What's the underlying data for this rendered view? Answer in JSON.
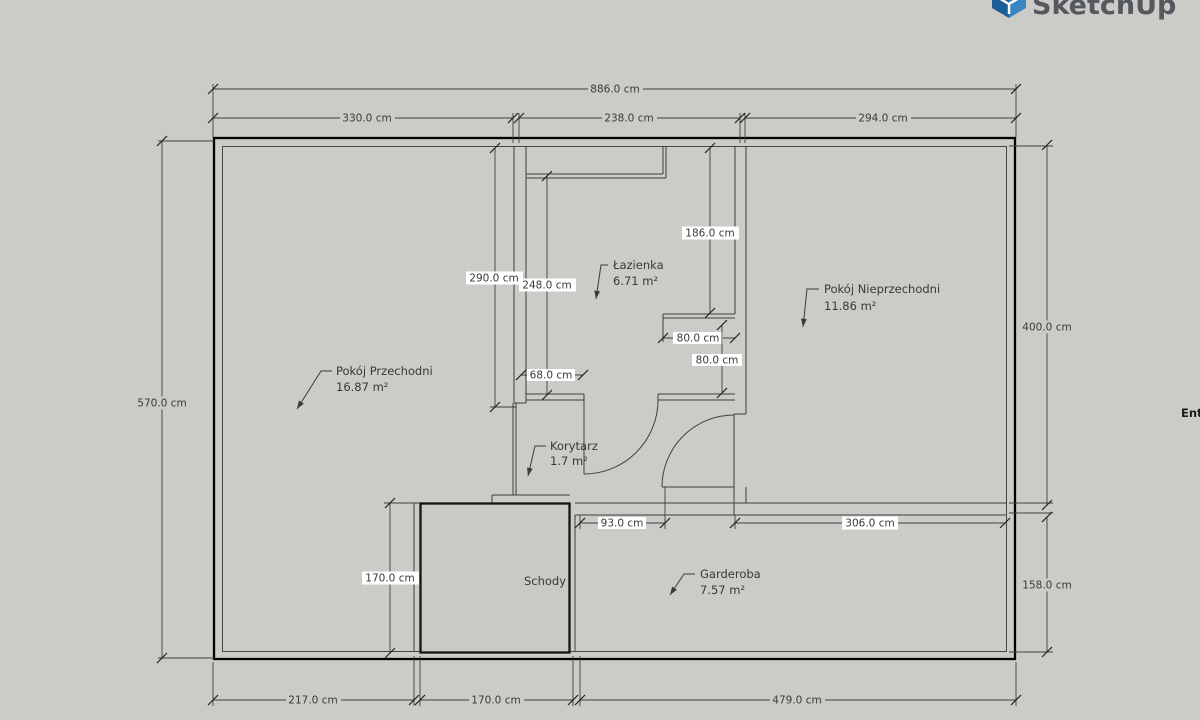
{
  "app": {
    "logo_text": "SketchUp",
    "panel_fragment": "Ent"
  },
  "colors": {
    "background": "#cbccc7",
    "plan_fill": "#ffffff",
    "stairs_fill": "#c9cac5",
    "wall_line": "#3f3f3f",
    "logo_blue_dark": "#1a5d97",
    "logo_blue_light": "#3b86c0",
    "logo_text_color": "#55585e"
  },
  "rooms": {
    "przechodni": {
      "name": "Pokój Przechodni",
      "area": "16.87 m²"
    },
    "lazienka": {
      "name": "Łazienka",
      "area": "6.71 m²"
    },
    "nieprzechodni": {
      "name": "Pokój Nieprzechodni",
      "area": "11.86 m²"
    },
    "korytarz": {
      "name": "Korytarz",
      "area": "1.7 m²"
    },
    "garderoba": {
      "name": "Garderoba",
      "area": "7.57 m²"
    },
    "schody": {
      "name": "Schody"
    }
  },
  "dimensions": {
    "overall_width": "886.0 cm",
    "top_left": "330.0 cm",
    "top_mid": "238.0 cm",
    "top_right": "294.0 cm",
    "overall_height": "570.0 cm",
    "right_upper": "400.0 cm",
    "right_lower": "158.0 cm",
    "bottom_left": "217.0 cm",
    "bottom_mid": "170.0 cm",
    "bottom_right": "479.0 cm",
    "przechodni_east": "290.0 cm",
    "lazienka_inner": "248.0 cm",
    "lazienka_east": "186.0 cm",
    "niche_width": "80.0 cm",
    "niche_height": "80.0 cm",
    "bath_door": "68.0 cm",
    "garderoba_door": "93.0 cm",
    "garderoba_width": "306.0 cm",
    "stairs_height": "170.0 cm"
  }
}
